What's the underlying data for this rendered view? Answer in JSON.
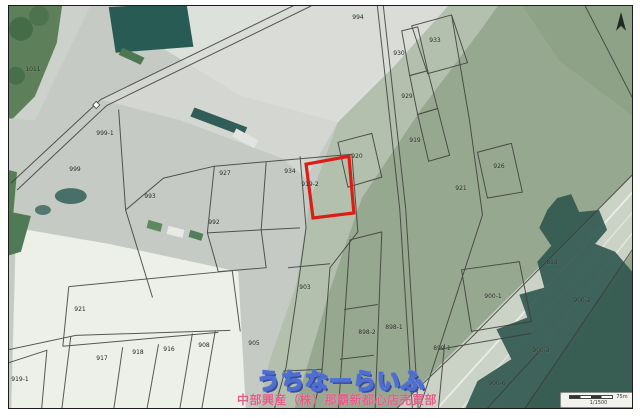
{
  "map": {
    "watermark": {
      "title": "うちなーらいふ",
      "company": "中部興産（株）那覇新都心店売買部",
      "title_color": "#4f6fd0",
      "company_color": "#e0608a"
    },
    "scale_bar": {
      "distance": "75m",
      "ratio": "1/1500"
    },
    "icons": {
      "compass": "north-arrow-icon"
    },
    "highlighted_parcel": {
      "label": "919-2",
      "color": "#dd1c14",
      "points": "306,164 349,156 354,213 313,218"
    },
    "parcel_labels": [
      {
        "text": "1011",
        "x": 32,
        "y": 69
      },
      {
        "text": "999-1",
        "x": 104,
        "y": 133
      },
      {
        "text": "999",
        "x": 74,
        "y": 169
      },
      {
        "text": "993",
        "x": 149,
        "y": 196
      },
      {
        "text": "927",
        "x": 224,
        "y": 173
      },
      {
        "text": "934",
        "x": 289,
        "y": 171
      },
      {
        "text": "919-2",
        "x": 309,
        "y": 184
      },
      {
        "text": "994",
        "x": 357,
        "y": 17
      },
      {
        "text": "933",
        "x": 434,
        "y": 40
      },
      {
        "text": "930",
        "x": 398,
        "y": 53
      },
      {
        "text": "929",
        "x": 406,
        "y": 96
      },
      {
        "text": "919",
        "x": 414,
        "y": 140
      },
      {
        "text": "920",
        "x": 356,
        "y": 156
      },
      {
        "text": "926",
        "x": 498,
        "y": 166
      },
      {
        "text": "921",
        "x": 460,
        "y": 188
      },
      {
        "text": "992",
        "x": 213,
        "y": 222
      },
      {
        "text": "903",
        "x": 304,
        "y": 287
      },
      {
        "text": "921",
        "x": 79,
        "y": 309
      },
      {
        "text": "905",
        "x": 253,
        "y": 343
      },
      {
        "text": "917",
        "x": 101,
        "y": 358
      },
      {
        "text": "918",
        "x": 137,
        "y": 352
      },
      {
        "text": "916",
        "x": 168,
        "y": 349
      },
      {
        "text": "908",
        "x": 203,
        "y": 345
      },
      {
        "text": "919-1",
        "x": 19,
        "y": 379
      },
      {
        "text": "898-2",
        "x": 366,
        "y": 332
      },
      {
        "text": "898-1",
        "x": 393,
        "y": 327
      },
      {
        "text": "899-1",
        "x": 441,
        "y": 348
      },
      {
        "text": "900-1",
        "x": 492,
        "y": 296
      },
      {
        "text": "900-2",
        "x": 581,
        "y": 300
      },
      {
        "text": "900-3",
        "x": 540,
        "y": 350
      },
      {
        "text": "900-6",
        "x": 496,
        "y": 383
      },
      {
        "text": "893",
        "x": 551,
        "y": 262
      }
    ]
  }
}
